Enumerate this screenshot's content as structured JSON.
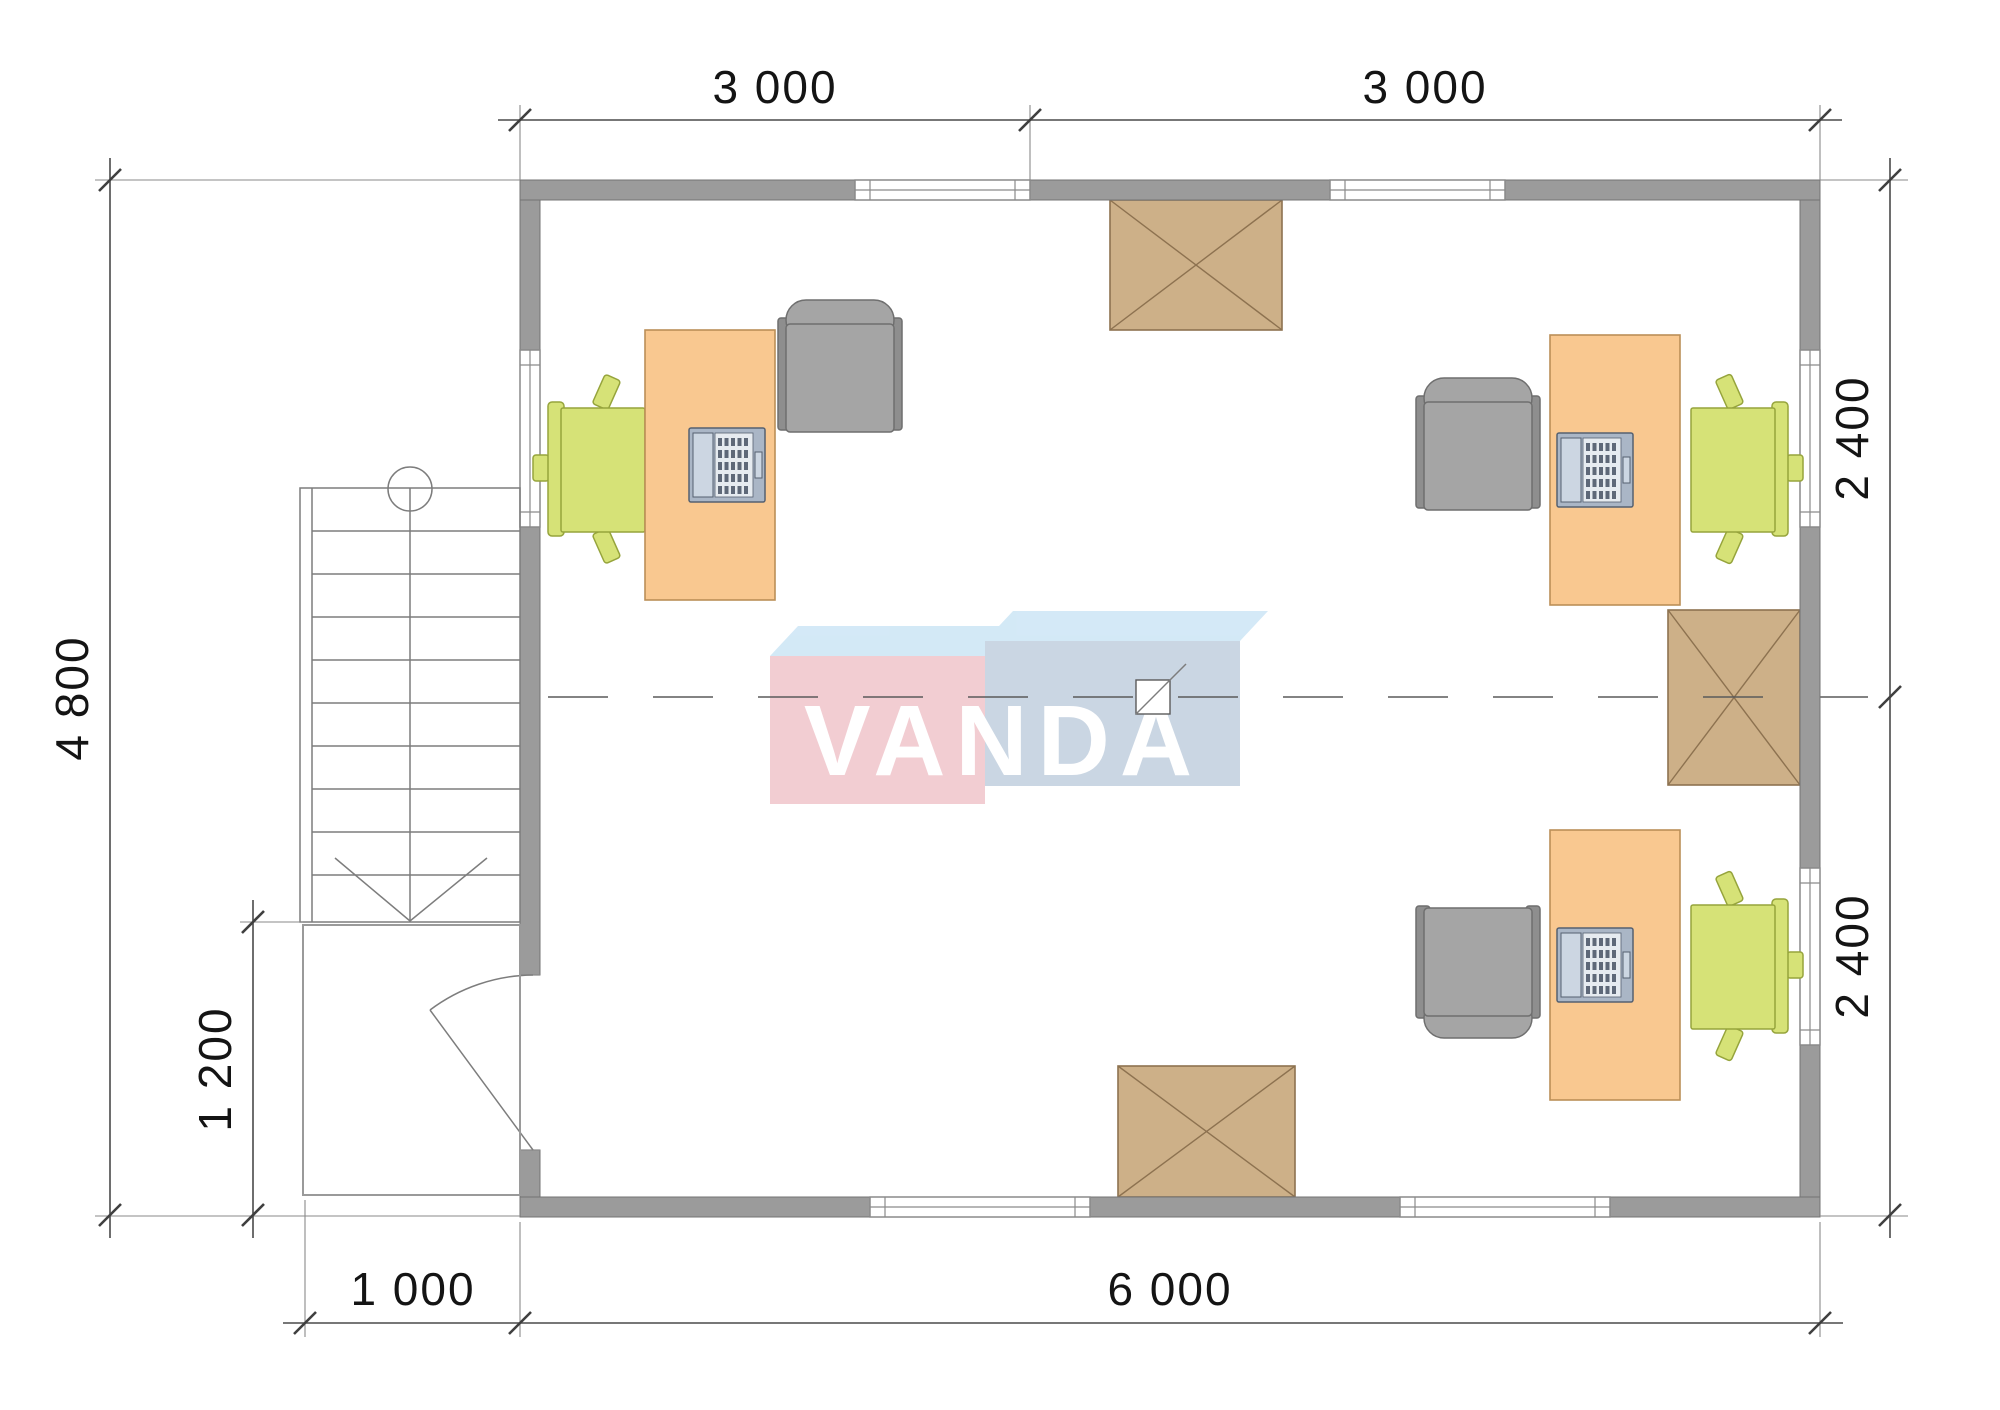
{
  "document": {
    "type": "architectural-floor-plan",
    "room_count": 1,
    "workstation_count": 3
  },
  "logo": {
    "text": "VANDA"
  },
  "dimensions": {
    "top": [
      "3 000",
      "3 000"
    ],
    "left_total": "4 800",
    "left_porch": "1 200",
    "right": [
      "2 400",
      "2 400"
    ],
    "bottom_porch": "1 000",
    "bottom_total": "6 000"
  },
  "legend": {
    "desk": "office-desk",
    "green_chair": "task-chair",
    "gray_chair": "guest-armchair",
    "laptop": "laptop",
    "crate": "crossed-box-skylight",
    "stairs": "staircase-down-arrow",
    "door": "entrance-door-swing",
    "porch": "entrance-porch",
    "window": "window-opening"
  },
  "colors": {
    "wall": "#9b9b9b",
    "wall-edge": "#737373",
    "desk": "#f9c890",
    "desk-edge": "#bb8f58",
    "chair-green": "#d6e277",
    "chair-green-edge": "#96a43c",
    "armchair": "#a5a5a5",
    "armchair-dark": "#8e8e8e",
    "armchair-edge": "#6f6f6f",
    "crate": "#cdb088",
    "crate-edge": "#8d7250",
    "logo-pink": "#f1c8ce",
    "logo-blue": "#c5d2e0",
    "logo-top": "#cfe7f6",
    "logo-text": "#ffffff",
    "laptop-body": "#aab6c6",
    "laptop-screen": "#ccd6e2",
    "laptop-edge": "#556070"
  }
}
